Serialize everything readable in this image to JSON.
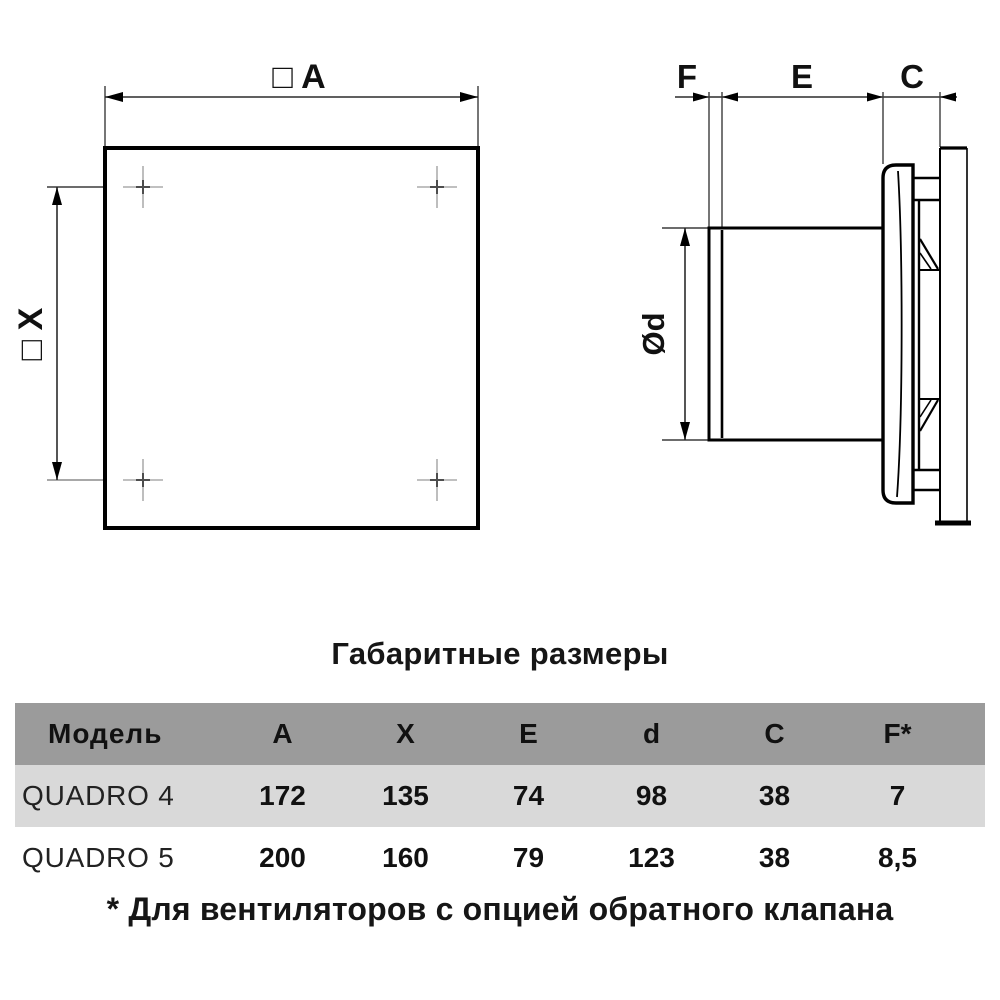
{
  "section_title": "Габаритные размеры",
  "drawing": {
    "front_view": {
      "side_label": "□ A",
      "holes_label": "□ X"
    },
    "side_view": {
      "f_label": "F",
      "e_label": "E",
      "c_label": "C",
      "d_label": "Ød"
    }
  },
  "table": {
    "headers": [
      "Модель",
      "A",
      "X",
      "E",
      "d",
      "C",
      "F*"
    ],
    "rows": [
      {
        "model": "QUADRO 4",
        "values": [
          "172",
          "135",
          "74",
          "98",
          "38",
          "7"
        ]
      },
      {
        "model": "QUADRO 5",
        "values": [
          "200",
          "160",
          "79",
          "123",
          "38",
          "8,5"
        ]
      }
    ]
  },
  "footnote": "* Для вентиляторов с опцией обратного клапана",
  "colors": {
    "drawing_line": "#000000",
    "dimension_line": "#2b2b2b",
    "crosshair": "#9a9a9a",
    "table_header_bg": "#9b9b9b",
    "table_row_alt_bg": "#d9d9d9",
    "text": "#161616"
  }
}
